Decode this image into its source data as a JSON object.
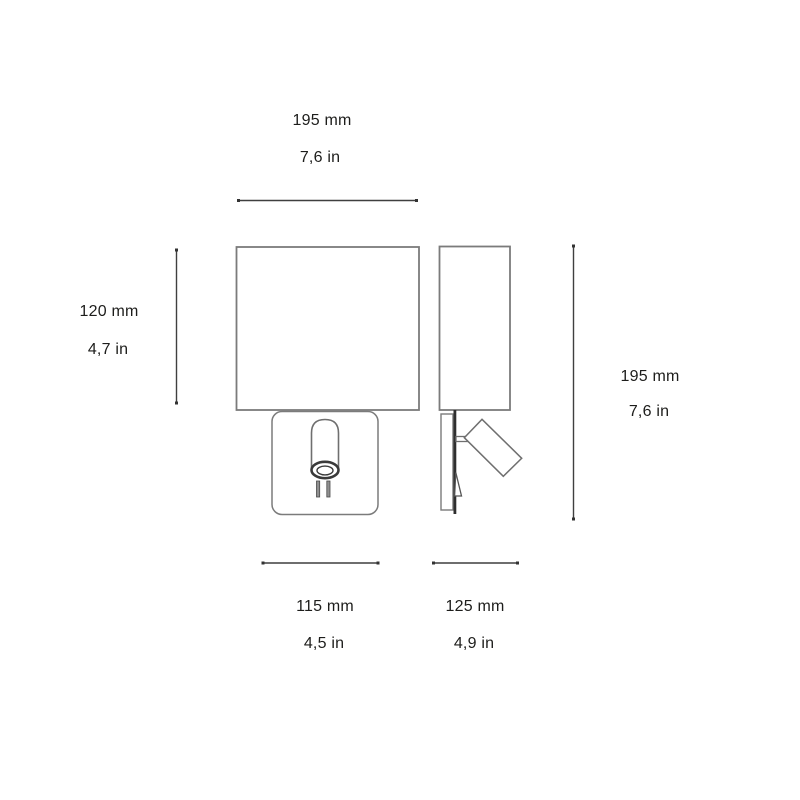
{
  "page": {
    "title": "Wall lamp with reading light - dimensional drawing",
    "background": "#ffffff"
  },
  "colors": {
    "drawing_line": "#7b7b7b",
    "dimension_line": "#3f3f3f",
    "dark_detail": "#2f2f2f",
    "text": "#1d1d1b"
  },
  "dimensions": {
    "shade_width": {
      "mm": "195 mm",
      "in": "7,6 in"
    },
    "shade_height": {
      "mm": "120 mm",
      "in": "4,7 in"
    },
    "overall_height": {
      "mm": "195 mm",
      "in": "7,6 in"
    },
    "backplate_width": {
      "mm": "115 mm",
      "in": "4,5 in"
    },
    "overall_depth": {
      "mm": "125 mm",
      "in": "4,9 in"
    }
  }
}
